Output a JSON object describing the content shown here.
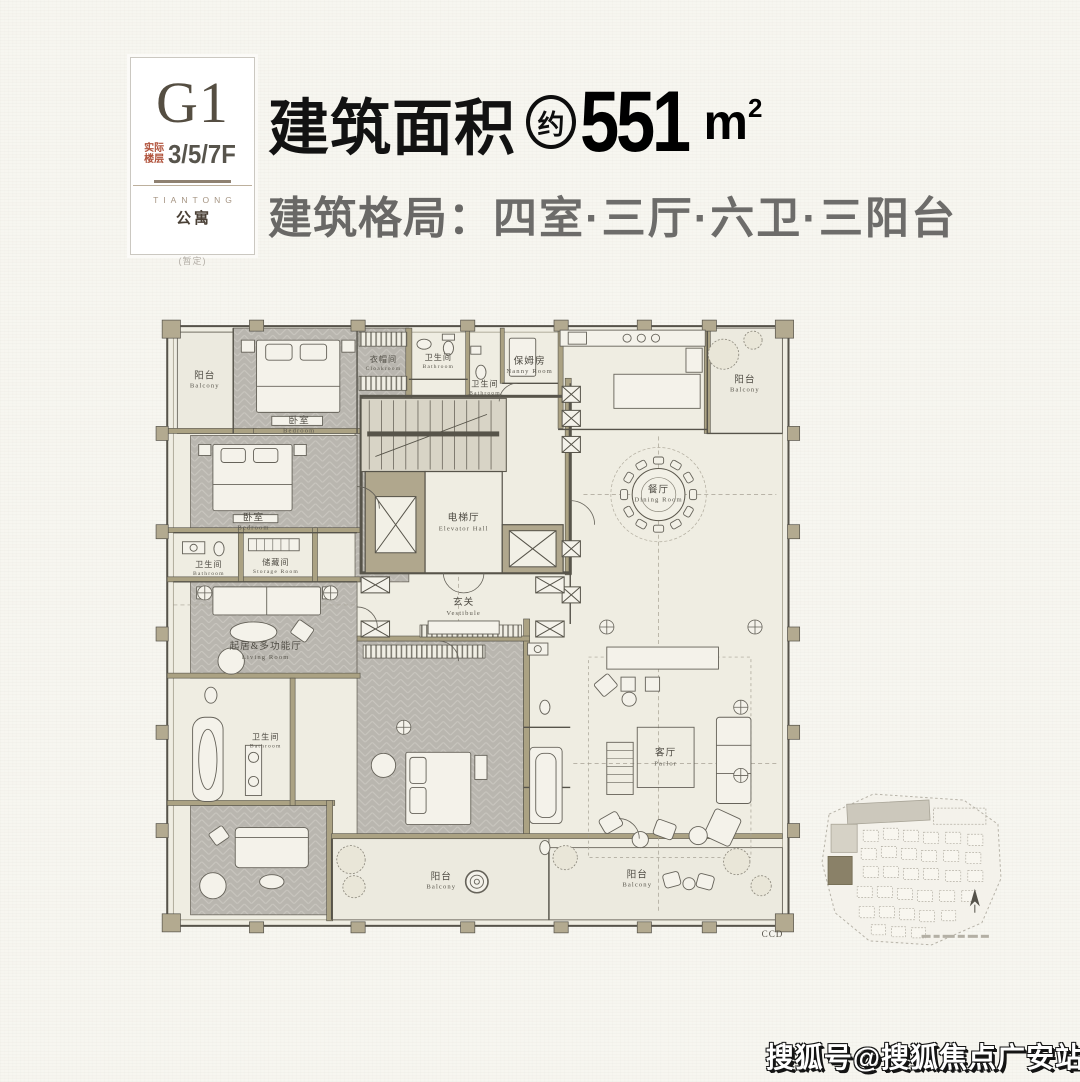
{
  "badge": {
    "code": "G1",
    "floor_label": "实际楼层",
    "floor_value": "3/5/7F",
    "brand_en": "TIANTONG",
    "brand_cn": "公寓",
    "note": "(暂定)"
  },
  "title": {
    "area_label": "建筑面积",
    "approx_mark": "约",
    "area_value": "551",
    "area_unit": "m",
    "area_unit_exp": "2",
    "layout_label": "建筑格局：",
    "layout_value": "四室·三厅·六卫·三阳台"
  },
  "floorplan": {
    "signature": "CCD",
    "rooms": {
      "balcony_tl": {
        "zh": "阳台",
        "en": "Balcony"
      },
      "bedroom_top": {
        "zh": "卧室",
        "en": "Bedroom"
      },
      "cloakroom": {
        "zh": "衣帽间",
        "en": "Cloakroom"
      },
      "bath_top": {
        "zh": "卫生间",
        "en": "Bathroom"
      },
      "bath_top2": {
        "zh": "卫生间",
        "en": "Bathroom"
      },
      "nanny": {
        "zh": "保姆房",
        "en": "Nanny Room"
      },
      "balcony_tr": {
        "zh": "阳台",
        "en": "Balcony"
      },
      "bedroom_left": {
        "zh": "卧室",
        "en": "Bedroom"
      },
      "bath_mid": {
        "zh": "卫生间",
        "en": "Bathroom"
      },
      "storage": {
        "zh": "储藏间",
        "en": "Storage Room"
      },
      "elevator_hall": {
        "zh": "电梯厅",
        "en": "Elevator Hall"
      },
      "dining": {
        "zh": "餐厅",
        "en": "Dining Room"
      },
      "vestibule": {
        "zh": "玄关",
        "en": "Vestibule"
      },
      "living": {
        "zh": "起居&多功能厅",
        "en": "Living Room"
      },
      "bath_low": {
        "zh": "卫生间",
        "en": "Bathroom"
      },
      "parlor": {
        "zh": "客厅",
        "en": "Parlor"
      },
      "balcony_bc": {
        "zh": "阳台",
        "en": "Balcony"
      },
      "balcony_br": {
        "zh": "阳台",
        "en": "Balcony"
      }
    }
  },
  "watermark": {
    "text": "搜狐号@搜狐焦点广安站"
  },
  "colors": {
    "page_bg": "#f7f6f0",
    "ink": "#111111",
    "headline_gray": "#6d6c6a",
    "badge_accent_red": "#b0523b",
    "badge_taupe": "#554e42",
    "plan_cream": "#efede2",
    "plan_floor_gray": "#b9b6af",
    "plan_wall_taupe": "#aba283",
    "plan_line": "#56534a"
  }
}
